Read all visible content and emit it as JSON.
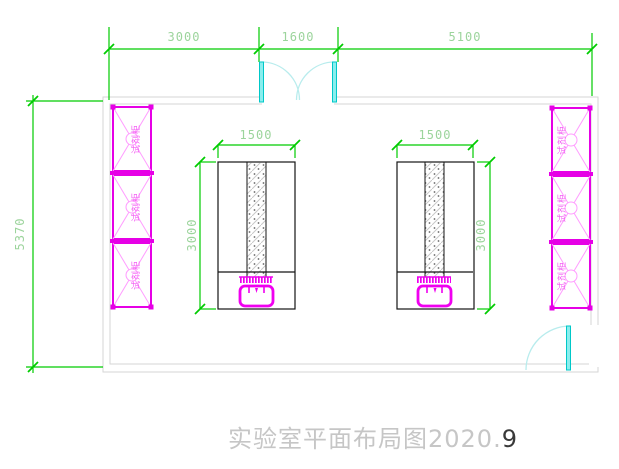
{
  "drawing": {
    "title_main": "实验室平面布局图2020.",
    "title_suffix": "9"
  },
  "dimensions": {
    "top_left": "3000",
    "top_middle": "1600",
    "top_right": "5100",
    "wall_left": "5370",
    "bench_left_width": "1500",
    "bench_left_depth": "3000",
    "bench_right_width": "1500",
    "bench_right_depth": "3000"
  },
  "labels": {
    "cabinet": "试剂柜"
  },
  "layout_counts": {
    "left_wall_cabinets": 3,
    "right_wall_cabinets": 3,
    "benches": 2
  },
  "colors": {
    "dimension_line": "#00cc00",
    "dimension_text": "#9cd49c",
    "wall": "#d6d6d6",
    "cabinet": "#e600e6",
    "cabinet_light": "#ff9dff",
    "sink": "#f000f0",
    "door_leaf": "#8aeeee",
    "door_arc": "#b8eced",
    "bench_outline": "#151515",
    "title_gray": "#c6c6c6",
    "title_dark": "#3a3a3a"
  }
}
